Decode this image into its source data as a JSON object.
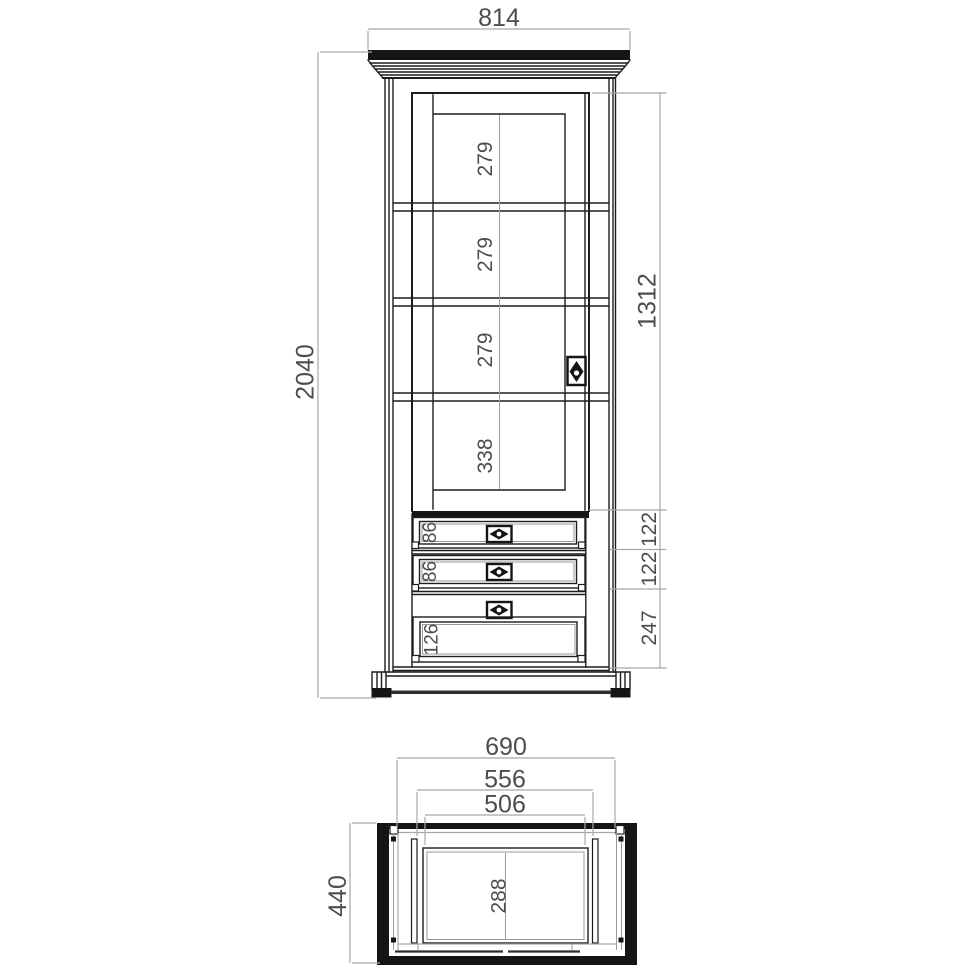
{
  "drawing": {
    "background": "#ffffff",
    "line_color": "#1d1d1d",
    "dim_line_color": "#a8a8a8",
    "dim_text_color": "#4d4d4d",
    "icons": {
      "door_handle": "escutcheon-plate",
      "drawer_handle": "escutcheon-plate"
    },
    "front_view": {
      "total_width": "814",
      "total_height": "2040",
      "door_height": "1312",
      "compartments": [
        {
          "label": "279"
        },
        {
          "label": "279"
        },
        {
          "label": "279"
        },
        {
          "label": "338"
        }
      ],
      "drawers": [
        {
          "label": "86"
        },
        {
          "label": "86"
        },
        {
          "label": "126"
        }
      ],
      "right_segments": [
        {
          "label": "122"
        },
        {
          "label": "122"
        },
        {
          "label": "247"
        }
      ]
    },
    "top_view": {
      "outer_width": "690",
      "inner_width": "556",
      "opening_width": "506",
      "depth": "440",
      "inner_depth": "288"
    }
  }
}
